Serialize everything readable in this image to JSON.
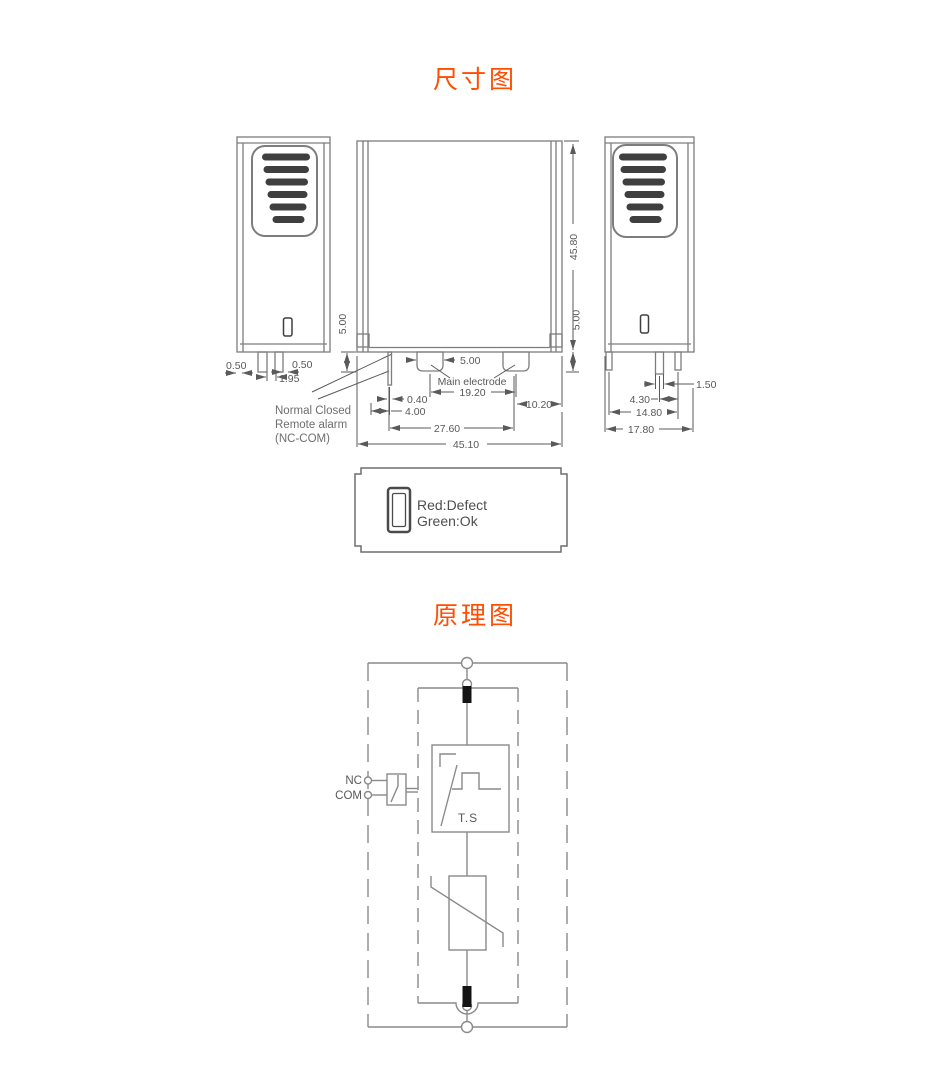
{
  "titles": {
    "dimensions": "尺寸图",
    "schematic": "原理图"
  },
  "colors": {
    "accent": "#ff4e00",
    "linework": "#7d7d7d",
    "dimension_text": "#595959",
    "slot_fill": "#3f3f3f",
    "electrode_fill": "#141414"
  },
  "left_view": {
    "dim_pin_left_offset": "0.50",
    "dim_pin_gap": "1.95",
    "dim_pin_right_offset": "0.50",
    "note_line1": "Normal Closed",
    "note_line2": "Remote alarm",
    "note_line3": "(NC-COM)"
  },
  "front_view": {
    "dim_height": "45.80",
    "dim_pin_length_left": "5.00",
    "dim_pin_length_right": "5.00",
    "dim_electrode_width": "5.00",
    "dim_electrode_pitch": "19.20",
    "dim_signal_pin_width": "0.40",
    "dim_signal_pin_offset": "4.00",
    "dim_right_offset": "10.20",
    "dim_electrode_span": "27.60",
    "dim_total_width": "45.10",
    "label_main_electrode": "Main electrode"
  },
  "right_view": {
    "dim_pin_width": "1.50",
    "dim_pin_offset": "4.30",
    "dim_pin_span": "14.80",
    "dim_total_width": "17.80"
  },
  "top_view": {
    "led_line1": "Red:Defect",
    "led_line2": "Green:Ok"
  },
  "schematic": {
    "terminal_nc": "NC",
    "terminal_com": "COM",
    "thermal_switch": "T.S"
  }
}
